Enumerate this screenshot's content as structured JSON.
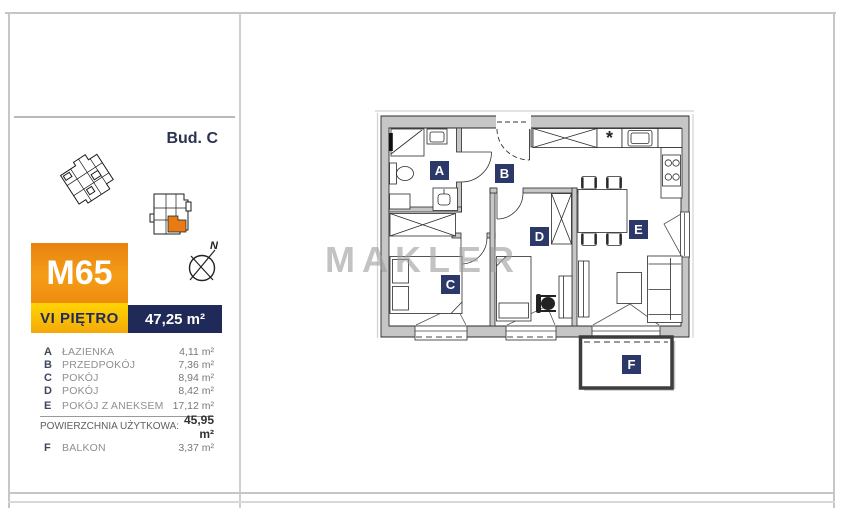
{
  "building_label": "Bud. C",
  "unit": {
    "id": "M65",
    "floor": "VI PIĘTRO",
    "total_area": "47,25 m²"
  },
  "legend": {
    "rooms": [
      {
        "letter": "A",
        "name": "ŁAZIENKA",
        "area": "4,11 m²"
      },
      {
        "letter": "B",
        "name": "PRZEDPOKÓJ",
        "area": "7,36 m²"
      },
      {
        "letter": "C",
        "name": "POKÓJ",
        "area": "8,94 m²"
      },
      {
        "letter": "D",
        "name": "POKÓJ",
        "area": "8,42 m²"
      },
      {
        "letter": "E",
        "name": "POKÓJ Z ANEKSEM",
        "area": "17,12 m²"
      }
    ],
    "usable_area_label": "POWIERZCHNIA UŻYTKOWA:",
    "usable_area_value": "45,95 m²",
    "balcony": {
      "letter": "F",
      "name": "BALKON",
      "area": "3,37 m²"
    }
  },
  "plan": {
    "room_labels": {
      "a": "A",
      "b": "B",
      "c": "C",
      "d": "D",
      "e": "E",
      "f": "F"
    },
    "kitchen_symbol": "*"
  },
  "compass": {
    "north": "N"
  },
  "watermark": "MAKLER",
  "colors": {
    "accent_orange": "#ef8c10",
    "accent_yellow": "#ffd501",
    "accent_navy": "#1f2a58",
    "label_navy": "#2c3968",
    "unit_highlight_orange": "#e87b17"
  }
}
